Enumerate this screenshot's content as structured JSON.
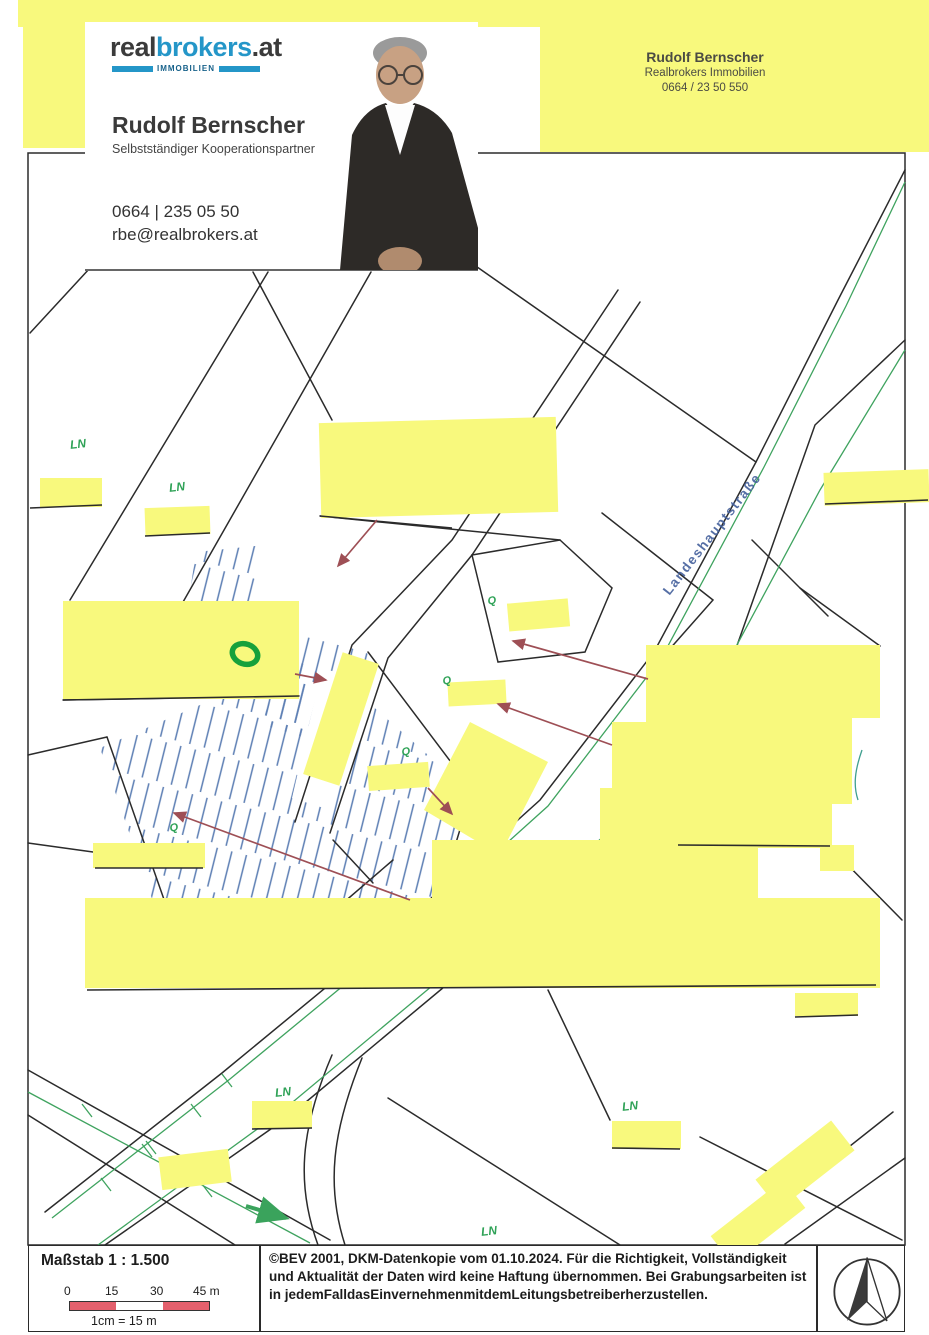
{
  "colors": {
    "highlight_yellow": "#f8f97d",
    "map_line_black": "#2b2b2b",
    "road_green": "#3fa35f",
    "label_green": "#2fa257",
    "hatch_blue": "#5b7db3",
    "arrow_red": "#9e4f55",
    "road_label_blue": "#44609c",
    "logo_blue": "#2496c8",
    "scalebar_red": "#e4606d",
    "ring_green": "#17a13b"
  },
  "business_card": {
    "logo_part1": "real",
    "logo_part2": "brokers",
    "logo_part3": ".at",
    "logo_tagline": "IMMOBILIEN",
    "name": "Rudolf Bernscher",
    "subtitle": "Selbstständiger Kooperationspartner",
    "phone": "0664 | 235 05 50",
    "email": "rbe@realbrokers.at"
  },
  "contact_note": {
    "name": "Rudolf Bernscher",
    "company": "Realbrokers Immobilien",
    "phone": "0664 / 23 50 550"
  },
  "map": {
    "labels": [
      {
        "cls": "road",
        "text": "Landeshauptstraße",
        "x": 712,
        "y": 534,
        "rot": -52,
        "size": 13.5
      },
      {
        "cls": "ln",
        "text": "LN",
        "x": 78,
        "y": 444,
        "rot": -6,
        "size": 12
      },
      {
        "cls": "ln",
        "text": "LN",
        "x": 177,
        "y": 487,
        "rot": -6,
        "size": 12
      },
      {
        "cls": "ln",
        "text": "LN",
        "x": 283,
        "y": 1092,
        "rot": -6,
        "size": 12
      },
      {
        "cls": "ln",
        "text": "LN",
        "x": 630,
        "y": 1106,
        "rot": -6,
        "size": 12
      },
      {
        "cls": "ln",
        "text": "LN",
        "x": 489,
        "y": 1231,
        "rot": -6,
        "size": 12
      },
      {
        "cls": "q",
        "text": "Q",
        "x": 492,
        "y": 601,
        "rot": -10,
        "size": 11
      },
      {
        "cls": "q",
        "text": "Q",
        "x": 447,
        "y": 681,
        "rot": -10,
        "size": 11
      },
      {
        "cls": "q",
        "text": "Q",
        "x": 406,
        "y": 752,
        "rot": -10,
        "size": 11
      },
      {
        "cls": "q",
        "text": "Q",
        "x": 174,
        "y": 828,
        "rot": -10,
        "size": 11
      }
    ]
  },
  "footer": {
    "scale_label": "Maßstab 1 : 1.500",
    "scale_ticks": [
      "0",
      "15",
      "30",
      "45 m"
    ],
    "scale_note": "1cm = 15 m",
    "copyright_lines": [
      "©BEV 2001, DKM-Datenkopie vom 01.10.2024. Für die Richtigkeit, Vollständigkeit",
      "und Aktualität der Daten wird keine Haftung übernommen. Bei Grabungsarbeiten ist in",
      "jedemFalldasEinvernehmenmitdemLeitungsbetreiberherzustellen."
    ]
  }
}
